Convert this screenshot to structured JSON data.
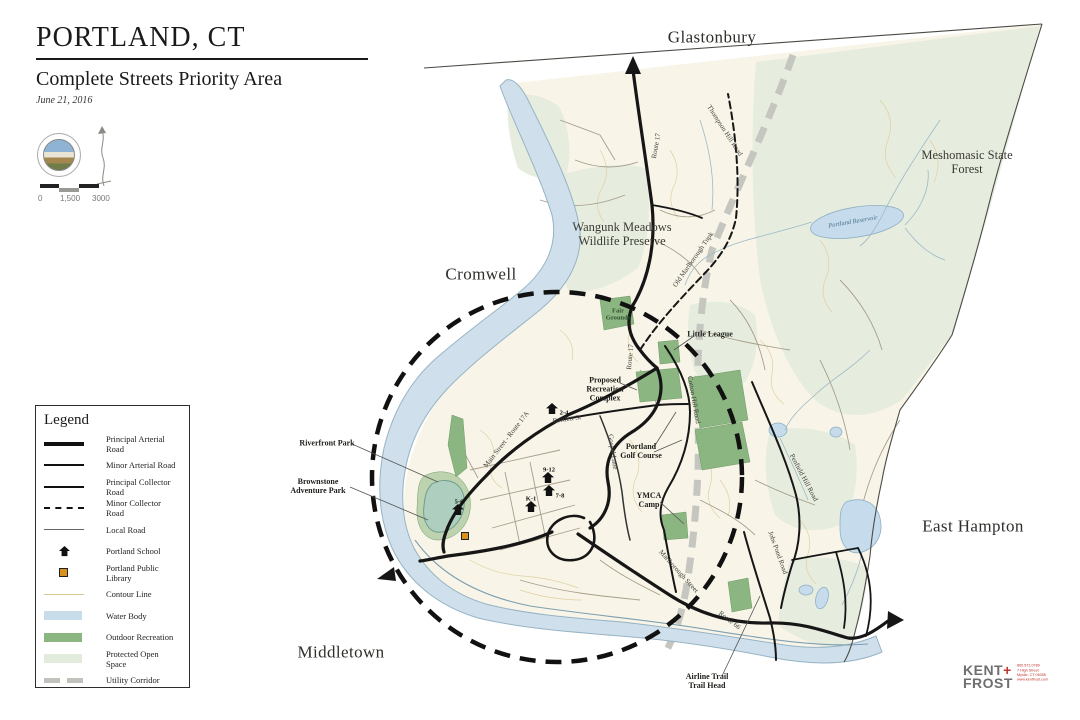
{
  "title_block": {
    "title": "PORTLAND, CT",
    "subtitle": "Complete Streets Priority Area",
    "date": "June 21, 2016"
  },
  "scale_bar": {
    "labels": [
      "0",
      "1,500",
      "3000"
    ]
  },
  "legend": {
    "title": "Legend",
    "items": [
      {
        "symbol": "principal-arterial",
        "label": "Principal Arterial Road"
      },
      {
        "symbol": "minor-arterial",
        "label": "Minor Arterial Road"
      },
      {
        "symbol": "principal-collector",
        "label": "Principal Collector Road"
      },
      {
        "symbol": "minor-collector",
        "label": "Minor Collector Road"
      },
      {
        "symbol": "local",
        "label": "Local Road"
      },
      {
        "symbol": "school",
        "label": "Portland School"
      },
      {
        "symbol": "library",
        "label": "Portland Public Library"
      },
      {
        "symbol": "contour",
        "label": "Contour Line"
      },
      {
        "symbol": "water",
        "label": "Water Body"
      },
      {
        "symbol": "recreation",
        "label": "Outdoor Recreation"
      },
      {
        "symbol": "open-space",
        "label": "Protected Open Space"
      },
      {
        "symbol": "utility",
        "label": "Utility Corridor"
      }
    ]
  },
  "map": {
    "town_labels": [
      {
        "text": "Glastonbury",
        "x": 712,
        "y": 37
      },
      {
        "text": "Cromwell",
        "x": 481,
        "y": 274
      },
      {
        "text": "Middletown",
        "x": 341,
        "y": 652
      },
      {
        "text": "East Hampton",
        "x": 973,
        "y": 526
      }
    ],
    "area_labels": [
      {
        "text": "Meshomasic State\nForest",
        "x": 967,
        "y": 162
      },
      {
        "text": "Wangunk Meadows\nWildlife Preserve",
        "x": 622,
        "y": 234
      }
    ],
    "callout_labels": [
      {
        "text": "Riverfront Park",
        "x": 327,
        "y": 444
      },
      {
        "text": "Brownstone\nAdventure Park",
        "x": 318,
        "y": 487
      },
      {
        "text": "Proposed\nRecreation\nComplex",
        "x": 605,
        "y": 390
      },
      {
        "text": "Portland\nGolf Course",
        "x": 641,
        "y": 452
      },
      {
        "text": "YMCA\nCamp",
        "x": 649,
        "y": 501
      },
      {
        "text": "Little League",
        "x": 710,
        "y": 335
      },
      {
        "text": "Airline Trail\nTrail Head",
        "x": 707,
        "y": 682
      },
      {
        "text": "Fair\nGrounds",
        "x": 618,
        "y": 315,
        "cls": "green"
      }
    ],
    "road_labels": [
      {
        "text": "Thompson Hill Road",
        "x": 724,
        "y": 131,
        "rot": 57
      },
      {
        "text": "Route 17",
        "x": 657,
        "y": 146,
        "rot": -80
      },
      {
        "text": "Route 17",
        "x": 631,
        "y": 357,
        "rot": -85
      },
      {
        "text": "Old Marlborough Tnpk",
        "x": 694,
        "y": 260,
        "rot": -55
      },
      {
        "text": "Cotton Hill Road",
        "x": 693,
        "y": 400,
        "rot": 80
      },
      {
        "text": "Main Street - Route 17A",
        "x": 507,
        "y": 440,
        "rot": -52
      },
      {
        "text": "Bartlett St",
        "x": 567,
        "y": 420,
        "rot": -8
      },
      {
        "text": "Gospel Lane",
        "x": 612,
        "y": 452,
        "rot": 82
      },
      {
        "text": "Marlborough Street",
        "x": 678,
        "y": 572,
        "rot": 48
      },
      {
        "text": "Route 66",
        "x": 729,
        "y": 621,
        "rot": 38
      },
      {
        "text": "Jobs Pond Road",
        "x": 777,
        "y": 553,
        "rot": 70
      },
      {
        "text": "Penfield Hill Road",
        "x": 803,
        "y": 478,
        "rot": 62
      }
    ],
    "water_labels": [
      {
        "text": "Portland Reservoir",
        "x": 853,
        "y": 222,
        "rot": -10
      }
    ],
    "schools": [
      {
        "grades": "2-4",
        "x": 552,
        "y": 411,
        "lx": 564,
        "ly": 413
      },
      {
        "grades": "9-12",
        "x": 548,
        "y": 480,
        "lx": 549,
        "ly": 470
      },
      {
        "grades": "7-8",
        "x": 549,
        "y": 493,
        "lx": 560,
        "ly": 496
      },
      {
        "grades": "K-1",
        "x": 531,
        "y": 509,
        "lx": 531,
        "ly": 499
      },
      {
        "grades": "5-6",
        "x": 458,
        "y": 512,
        "lx": 459,
        "ly": 502
      }
    ],
    "library": {
      "x": 465,
      "y": 536
    }
  },
  "credit": {
    "name1": "KENT",
    "plus": "+",
    "name2": "FROST",
    "contact": [
      "860.572.0789",
      "7 High Street",
      "Mystic, CT 06355",
      "www.kentfrost.com"
    ]
  },
  "colors": {
    "map_cream": "#f8f5e8",
    "water": "#cfe0ec",
    "recreation": "#8cb681",
    "open_space": "#e6eddf",
    "utility_corridor": "#c6c6c0",
    "library": "#d8931e",
    "credit_accent": "#c0392b"
  }
}
